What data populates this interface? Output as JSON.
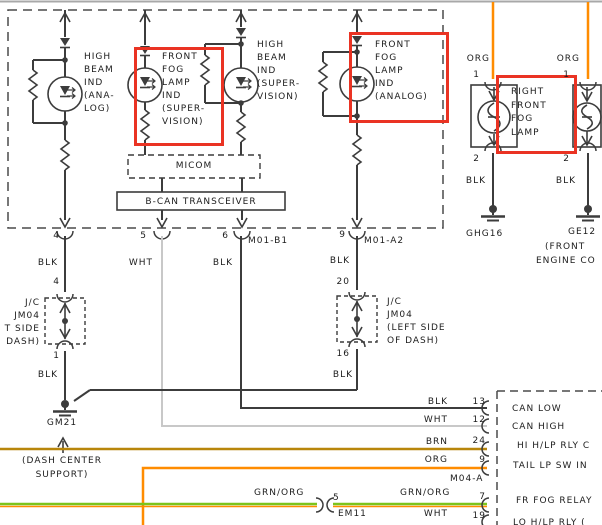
{
  "colors": {
    "wire_black": "#3c3c3c",
    "wire_white": "#c8c8c8",
    "wire_orange": "#ff8c00",
    "wire_brown": "#b8860b",
    "wire_green": "#7cc41c",
    "highlight_red": "#ea3323"
  },
  "cluster": {
    "high_beam_analog": "HIGH\nBEAM\nIND\n(ANA-\nLOG)",
    "front_fog_supervision": "FRONT\nFOG\nLAMP\nIND\n(SUPER-\nVISION)",
    "high_beam_supervision": "HIGH\nBEAM\nIND\n(SUPER-\nVISION)",
    "front_fog_analog": "FRONT\nFOG\nLAMP\nIND\n(ANALOG)",
    "micom": "MICOM",
    "bcan": "B-CAN TRANSCEIVER",
    "pin4": "4",
    "pin5": "5",
    "pin6": "6",
    "pin9": "9",
    "connector_b1": "M01-B1",
    "connector_a2": "M01-A2"
  },
  "labels": {
    "blk": "BLK",
    "wht": "WHT",
    "brn": "BRN",
    "org": "ORG",
    "grn_org": "GRN/ORG"
  },
  "left_branch": {
    "pin_jc_top": "4",
    "jc": "J/C\nJM04\nT SIDE\nDASH)",
    "pin_jc_bot": "1",
    "ground": "GM21",
    "ground_note": "(DASH CENTER\nSUPPORT)"
  },
  "mid_branch": {
    "pin_jc_top": "20",
    "jc": "J/C\nJM04\n(LEFT SIDE\nOF DASH)",
    "pin_jc_bot": "16"
  },
  "fog_lamps": {
    "pin1": "1",
    "pin2": "2",
    "label": "RIGHT\nFRONT\nFOG\nLAMP",
    "ground_left": "GHG16",
    "ground_right": "GE12",
    "ground_right_note1": "(FRONT",
    "ground_right_note2": "ENGINE CO"
  },
  "right_connector": {
    "name": "M04-A",
    "rows": [
      {
        "wire": "BLK",
        "pin": "13",
        "label": "CAN LOW"
      },
      {
        "wire": "WHT",
        "pin": "12",
        "label": "CAN HIGH"
      },
      {
        "wire": "BRN",
        "pin": "24",
        "label": "HI H/LP RLY C"
      },
      {
        "wire": "ORG",
        "pin": "9",
        "label": "TAIL LP SW IN"
      },
      {
        "wire": "GRN/ORG",
        "pin": "7",
        "label": "FR FOG RELAY"
      },
      {
        "wire": "WHT",
        "pin": "19",
        "label": "LO H/LP RLY ("
      }
    ]
  },
  "em11": {
    "name": "EM11",
    "pin": "5"
  }
}
